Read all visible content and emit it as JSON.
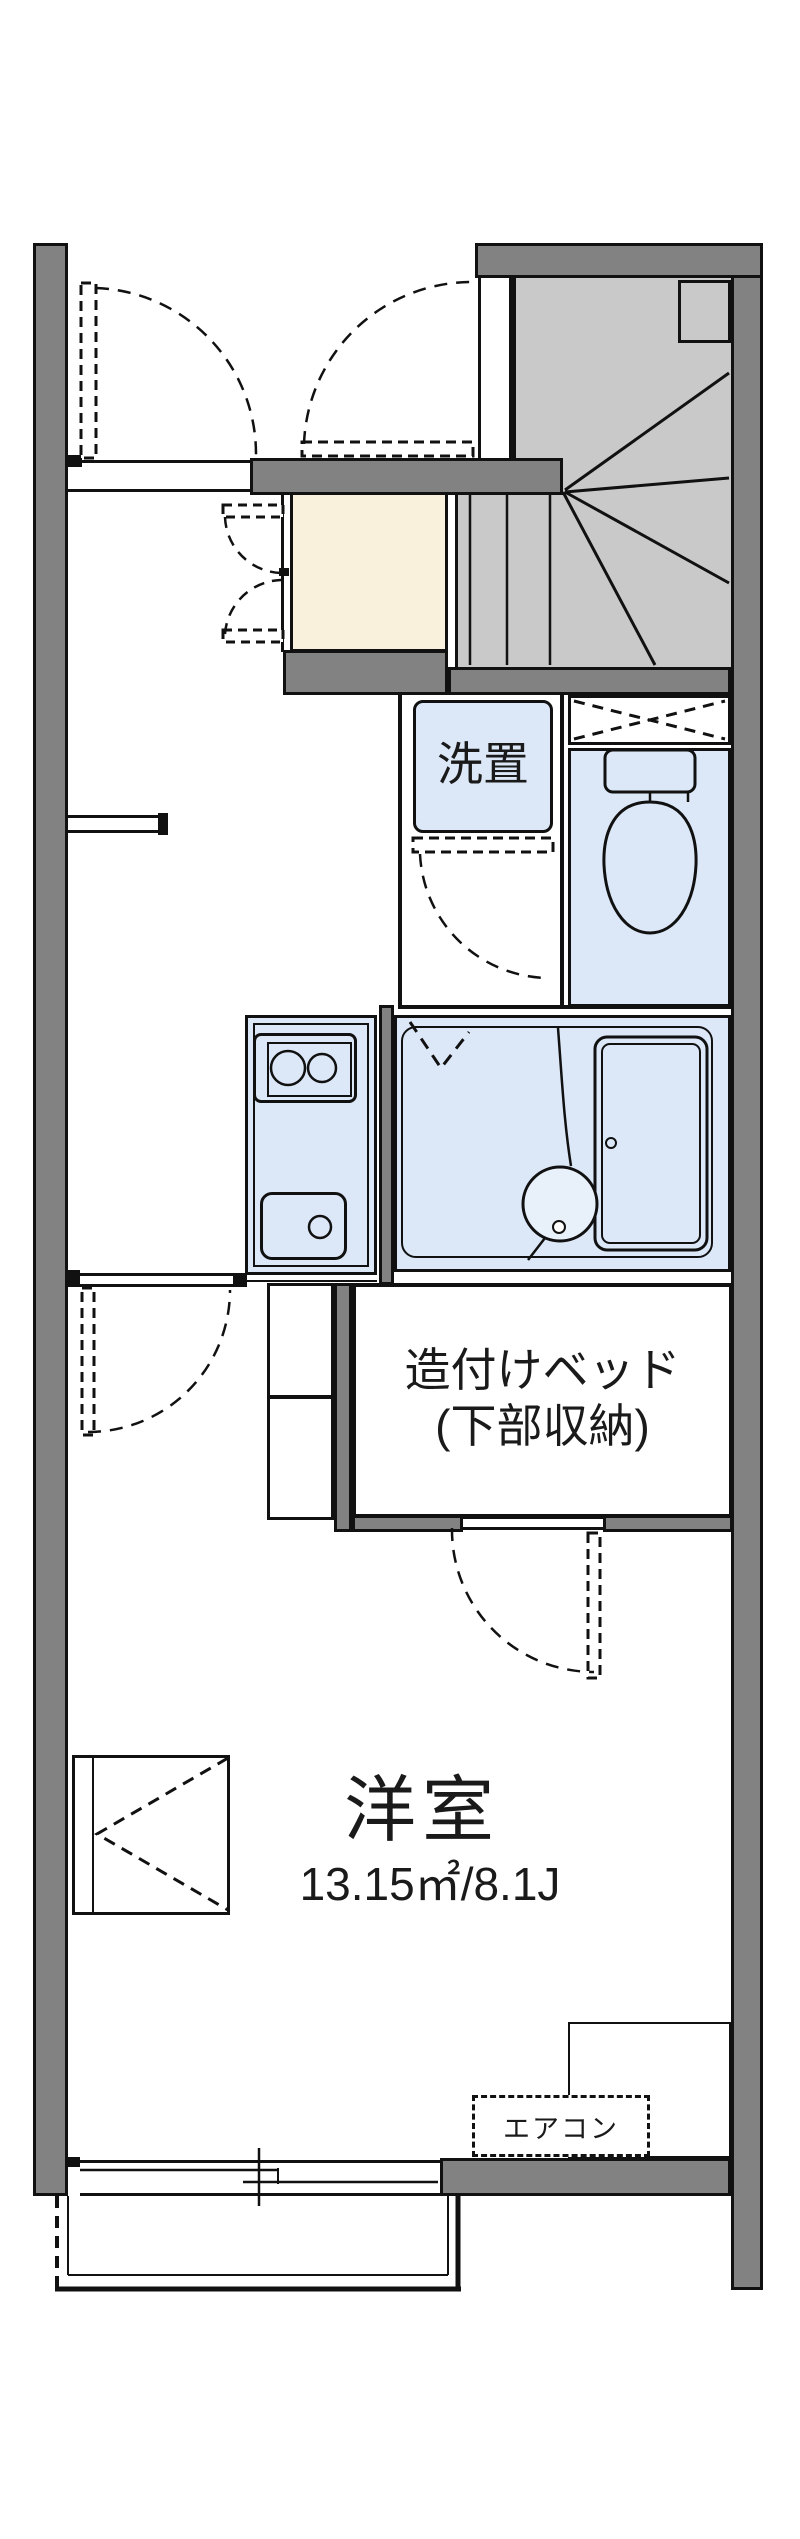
{
  "plan": {
    "laundry_label": "洗置",
    "bed_label_line1": "造付けベッド",
    "bed_label_line2": "(下部収納)",
    "room_label": "洋室",
    "room_area_label": "13.15㎡/8.1J",
    "aircon_label": "エアコン"
  },
  "fixtures": [
    "staircase",
    "toilet",
    "overhead-shelf",
    "washing-machine-space",
    "kitchen-stove",
    "kitchen-sink",
    "bathtub",
    "wash-basin",
    "built-in-bed",
    "storage-shelf",
    "closet",
    "entrance-door",
    "sliding-window",
    "balcony",
    "air-conditioner"
  ],
  "colors": {
    "wall": "#828282",
    "stair": "#c9c9c9",
    "fixture": "#dce8f8",
    "genkan": "#faf1dd",
    "line": "#111111",
    "bg": "#ffffff"
  }
}
